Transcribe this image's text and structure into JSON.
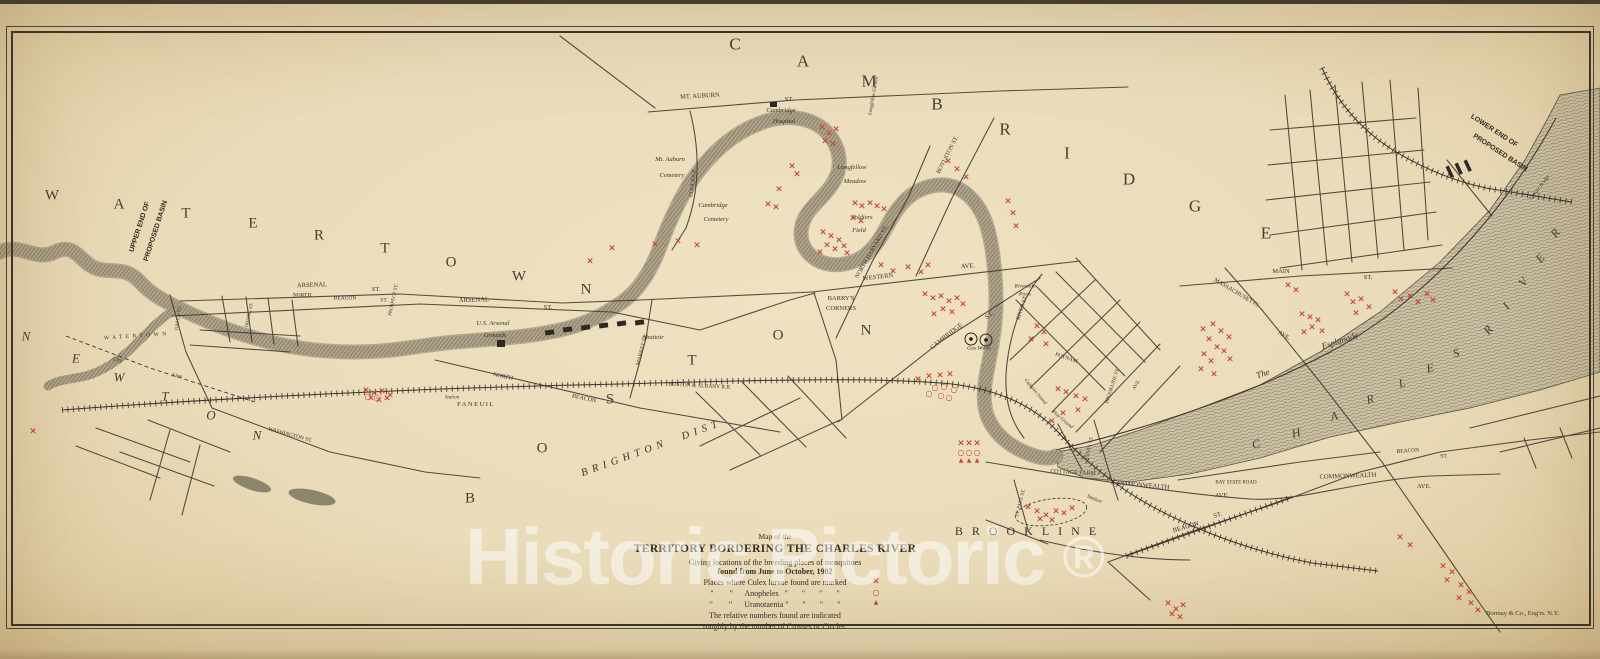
{
  "title_note": "Map of the Territory Bordering the Charles River, 1902",
  "colors": {
    "paper": "#eadcba",
    "ink": "#3a332a",
    "red_marker": "#c7453c",
    "water": "#b3a98f",
    "watermark": "#ffffff"
  },
  "watermark": {
    "text": "Historic Pictoric",
    "registered": "®"
  },
  "credit": "Bormay & Co., Eng'rs. N.Y.",
  "legend": {
    "l1": "Map of the",
    "l2": "TERRITORY BORDERING THE CHARLES RIVER",
    "l3": "Giving locations of the breeding places of mosquitoes",
    "l4": "found from June to October, 1902",
    "l5": "Places where Culex larvae found are marked",
    "l6": "\"        \"      Anopheles   \"       \"       \"       \"",
    "l7": "\"        \"      Uranotaenia \"       \"       \"       \"",
    "l8": "The relative numbers found are indicated",
    "l9": "roughly by the number of Crosses or Circles.",
    "markers": [
      "×",
      "○",
      "▲"
    ]
  },
  "districts": [
    {
      "name": "CAMBRIDGE",
      "s": 17,
      "letters": [
        [
          "C",
          735,
          44
        ],
        [
          "A",
          803,
          61
        ],
        [
          "M",
          869,
          81
        ],
        [
          "B",
          937,
          104
        ],
        [
          "R",
          1005,
          129
        ],
        [
          "I",
          1067,
          153
        ],
        [
          "D",
          1129,
          179
        ],
        [
          "G",
          1195,
          206
        ],
        [
          "E",
          1266,
          233
        ]
      ]
    },
    {
      "name": "WATERTOWN",
      "s": 15,
      "letters": [
        [
          "W",
          52,
          196
        ],
        [
          "A",
          119,
          205
        ],
        [
          "T",
          186,
          214
        ],
        [
          "E",
          253,
          224
        ],
        [
          "R",
          319,
          236
        ],
        [
          "T",
          385,
          249
        ],
        [
          "O",
          451,
          263
        ],
        [
          "W",
          519,
          277
        ],
        [
          "N",
          586,
          290
        ]
      ]
    },
    {
      "name": "BOSTON",
      "s": 15,
      "letters": [
        [
          "B",
          470,
          499
        ],
        [
          "O",
          542,
          449
        ],
        [
          "S",
          610,
          400
        ],
        [
          "T",
          692,
          361
        ],
        [
          "O",
          778,
          336
        ],
        [
          "N",
          866,
          331
        ]
      ]
    },
    {
      "name": "NEWTON",
      "s": 13,
      "i": 1,
      "letters": [
        [
          "N",
          26,
          336
        ],
        [
          "E",
          76,
          358
        ],
        [
          "W",
          119,
          377
        ],
        [
          "T",
          165,
          396
        ],
        [
          "O",
          211,
          415
        ],
        [
          "N",
          257,
          435
        ]
      ]
    },
    {
      "name": "CHARLES",
      "s": 12,
      "i": 1,
      "r": -15,
      "letters": [
        [
          "C",
          1256,
          444
        ],
        [
          "H",
          1296,
          433
        ],
        [
          "A",
          1334,
          416
        ],
        [
          "R",
          1370,
          399
        ],
        [
          "L",
          1402,
          383
        ],
        [
          "E",
          1430,
          368
        ],
        [
          "S",
          1456,
          353
        ]
      ]
    },
    {
      "name": "RIVER",
      "s": 12,
      "i": 1,
      "r": -50,
      "letters": [
        [
          "R",
          1488,
          330
        ],
        [
          "I",
          1506,
          306
        ],
        [
          "V",
          1523,
          282
        ],
        [
          "E",
          1540,
          258
        ],
        [
          "R",
          1555,
          233
        ]
      ]
    }
  ],
  "labels": [
    {
      "t": "MT. AUBURN",
      "x": 700,
      "y": 97,
      "r": -3
    },
    {
      "t": "ST.",
      "x": 789,
      "y": 100
    },
    {
      "t": "Cambridge",
      "x": 781,
      "y": 111,
      "c": "it"
    },
    {
      "t": "Hospital",
      "x": 784,
      "y": 122,
      "c": "it"
    },
    {
      "t": "Mt. Auburn",
      "x": 670,
      "y": 160,
      "c": "it"
    },
    {
      "t": "Cemetery",
      "x": 672,
      "y": 176,
      "c": "it"
    },
    {
      "t": "Cambridge",
      "x": 713,
      "y": 206,
      "c": "it"
    },
    {
      "t": "Cemetery",
      "x": 716,
      "y": 220,
      "c": "it"
    },
    {
      "t": "COOLIDGE",
      "x": 694,
      "y": 183,
      "r": -83,
      "s": 5.5
    },
    {
      "t": "Longfellow Garden",
      "x": 874,
      "y": 96,
      "r": -80,
      "s": 5,
      "c": "it"
    },
    {
      "t": "Longfellow",
      "x": 852,
      "y": 168,
      "c": "it"
    },
    {
      "t": "Meadow",
      "x": 855,
      "y": 182,
      "c": "it"
    },
    {
      "t": "BOYLSTON ST.",
      "x": 948,
      "y": 155,
      "r": -63,
      "s": 6
    },
    {
      "t": "Soldiers",
      "x": 862,
      "y": 218,
      "c": "it"
    },
    {
      "t": "Field",
      "x": 859,
      "y": 231,
      "c": "it"
    },
    {
      "t": "NORTH HARVARD ST.",
      "x": 872,
      "y": 252,
      "r": -60,
      "s": 6
    },
    {
      "t": "WESTERN",
      "x": 878,
      "y": 278,
      "r": -7
    },
    {
      "t": "AVE.",
      "x": 968,
      "y": 267,
      "r": -5
    },
    {
      "t": "BARRY'S",
      "x": 841,
      "y": 299
    },
    {
      "t": "CORNERS",
      "x": 841,
      "y": 309
    },
    {
      "t": "CAMBRIDGE",
      "x": 947,
      "y": 337,
      "r": -38
    },
    {
      "t": "ST.",
      "x": 990,
      "y": 316,
      "r": -38
    },
    {
      "t": "RIVER ST.",
      "x": 1023,
      "y": 308,
      "r": -72,
      "s": 5.5
    },
    {
      "t": "Riverside",
      "x": 1025,
      "y": 287,
      "c": "it",
      "s": 5.5
    },
    {
      "t": "Press",
      "x": 1025,
      "y": 295,
      "c": "it",
      "s": 5.5
    },
    {
      "t": "Gas Works",
      "x": 979,
      "y": 349,
      "c": "it",
      "s": 5.5
    },
    {
      "t": "PUTNAM",
      "x": 1066,
      "y": 359,
      "r": 18,
      "s": 5.5
    },
    {
      "t": "BROOKLINE ST.",
      "x": 1113,
      "y": 386,
      "r": -72,
      "s": 5
    },
    {
      "t": "AVE.",
      "x": 1137,
      "y": 385,
      "r": -60,
      "s": 5
    },
    {
      "t": "MASSACHUSETTS",
      "x": 1236,
      "y": 293,
      "r": 31,
      "s": 6
    },
    {
      "t": "AVE.",
      "x": 1284,
      "y": 336,
      "r": 31,
      "s": 6
    },
    {
      "t": "MAIN",
      "x": 1281,
      "y": 272
    },
    {
      "t": "ST.",
      "x": 1368,
      "y": 278
    },
    {
      "t": "The",
      "x": 1263,
      "y": 374,
      "r": -18,
      "c": "it",
      "s": 9
    },
    {
      "t": "Esplanade",
      "x": 1340,
      "y": 341,
      "r": -18,
      "c": "it",
      "s": 9
    },
    {
      "t": "Captains Island",
      "x": 1035,
      "y": 392,
      "r": 50,
      "s": 5,
      "c": "it"
    },
    {
      "t": "Play Ground",
      "x": 1062,
      "y": 420,
      "r": 40,
      "s": 5,
      "c": "it"
    },
    {
      "t": "COTTAGE FARM",
      "x": 1073,
      "y": 473,
      "r": 3,
      "s": 6
    },
    {
      "t": "COMMONWEALTH",
      "x": 1141,
      "y": 486,
      "r": 5
    },
    {
      "t": "AVE.",
      "x": 1222,
      "y": 496
    },
    {
      "t": "BAY STATE ROAD",
      "x": 1236,
      "y": 483,
      "s": 5
    },
    {
      "t": "COMMONWEALTH",
      "x": 1348,
      "y": 477,
      "r": -2
    },
    {
      "t": "AVE.",
      "x": 1424,
      "y": 487
    },
    {
      "t": "BEACON",
      "x": 1186,
      "y": 528,
      "r": -16
    },
    {
      "t": "ST.",
      "x": 1218,
      "y": 516,
      "r": -16
    },
    {
      "t": "BEACON",
      "x": 1408,
      "y": 452,
      "r": -4,
      "s": 5.5
    },
    {
      "t": "ST.",
      "x": 1444,
      "y": 457,
      "s": 5.5
    },
    {
      "t": "ST. PAUL ST.",
      "x": 1021,
      "y": 503,
      "r": -75,
      "s": 5
    },
    {
      "t": "ESSEX ST.",
      "x": 1090,
      "y": 448,
      "r": -78,
      "s": 5
    },
    {
      "t": "Station",
      "x": 1094,
      "y": 500,
      "r": 22,
      "c": "it",
      "s": 5.5
    },
    {
      "t": "ARSENAL",
      "x": 312,
      "y": 286,
      "r": -2
    },
    {
      "t": "ST.",
      "x": 376,
      "y": 290
    },
    {
      "t": "ARSENAL",
      "x": 474,
      "y": 301,
      "r": -2
    },
    {
      "t": "ST.",
      "x": 548,
      "y": 308
    },
    {
      "t": "U.S. Arsenal",
      "x": 493,
      "y": 324,
      "c": "it"
    },
    {
      "t": "Grounds",
      "x": 495,
      "y": 336,
      "c": "it"
    },
    {
      "t": "NORTH",
      "x": 302,
      "y": 296,
      "s": 5.5
    },
    {
      "t": "BEACON",
      "x": 345,
      "y": 299,
      "s": 5.5
    },
    {
      "t": "ST.",
      "x": 384,
      "y": 301,
      "s": 5.5
    },
    {
      "t": "PROSPECT ST.",
      "x": 394,
      "y": 300,
      "r": -78,
      "s": 5
    },
    {
      "t": "NORTH",
      "x": 503,
      "y": 377,
      "r": 12,
      "s": 6
    },
    {
      "t": "BEACON",
      "x": 584,
      "y": 399,
      "r": 12,
      "s": 6
    },
    {
      "t": "MARKET ST.",
      "x": 643,
      "y": 350,
      "r": -76,
      "s": 5.5
    },
    {
      "t": "BOSTON & ALBANY R.R.",
      "x": 700,
      "y": 387,
      "r": 3,
      "s": 5.5
    },
    {
      "t": "Station",
      "x": 452,
      "y": 398,
      "c": "it",
      "s": 5
    },
    {
      "t": "FANEUIL",
      "x": 476,
      "y": 405,
      "ls": 1.5
    },
    {
      "t": "WASHINGTON ST.",
      "x": 290,
      "y": 436,
      "r": 15,
      "s": 5.5
    },
    {
      "t": "IRVING ST.",
      "x": 250,
      "y": 315,
      "r": -78,
      "s": 5
    },
    {
      "t": "GALEN ST.",
      "x": 179,
      "y": 318,
      "r": -82,
      "s": 5
    },
    {
      "t": "City",
      "x": 117,
      "y": 361,
      "r": 12,
      "c": "it",
      "s": 5.5
    },
    {
      "t": "Line",
      "x": 177,
      "y": 377,
      "r": 12,
      "c": "it",
      "s": 5.5
    },
    {
      "t": "Abattoir",
      "x": 653,
      "y": 338,
      "c": "it"
    },
    {
      "t": "Craigie Bridge",
      "x": 1540,
      "y": 188,
      "r": -52,
      "s": 5,
      "c": "it"
    },
    {
      "t": "UPPER END OF",
      "x": 140,
      "y": 227,
      "r": -72,
      "s": 7,
      "c": "b"
    },
    {
      "t": "PROPOSED BASIN",
      "x": 156,
      "y": 231,
      "r": -72,
      "s": 7,
      "c": "b"
    },
    {
      "t": "LOWER END OF",
      "x": 1494,
      "y": 131,
      "r": 33,
      "s": 7,
      "c": "b"
    },
    {
      "t": "PROPOSED BASIN",
      "x": 1500,
      "y": 153,
      "r": 33,
      "s": 7,
      "c": "b"
    },
    {
      "t": "BRIGHTON  DIST",
      "x": 652,
      "y": 449,
      "r": -20,
      "s": 10.5,
      "ls": 5,
      "c": "it"
    },
    {
      "t": "BROOKLINE",
      "x": 1030,
      "y": 531,
      "s": 12,
      "ls": 9
    },
    {
      "t": "WATERTOWN",
      "x": 137,
      "y": 337,
      "r": -4,
      "s": 5.5,
      "ls": 3.5
    }
  ],
  "markers": {
    "cross": [
      [
        822,
        128
      ],
      [
        829,
        134
      ],
      [
        836,
        130
      ],
      [
        825,
        142
      ],
      [
        833,
        145
      ],
      [
        948,
        162
      ],
      [
        957,
        170
      ],
      [
        966,
        178
      ],
      [
        1008,
        202
      ],
      [
        1013,
        214
      ],
      [
        1016,
        227
      ],
      [
        792,
        167
      ],
      [
        797,
        175
      ],
      [
        779,
        190
      ],
      [
        768,
        205
      ],
      [
        776,
        208
      ],
      [
        590,
        262
      ],
      [
        612,
        249
      ],
      [
        655,
        245
      ],
      [
        678,
        242
      ],
      [
        697,
        246
      ],
      [
        855,
        204
      ],
      [
        862,
        207
      ],
      [
        870,
        204
      ],
      [
        877,
        207
      ],
      [
        884,
        210
      ],
      [
        853,
        219
      ],
      [
        861,
        222
      ],
      [
        823,
        233
      ],
      [
        831,
        237
      ],
      [
        839,
        241
      ],
      [
        827,
        246
      ],
      [
        835,
        250
      ],
      [
        844,
        247
      ],
      [
        820,
        253
      ],
      [
        847,
        254
      ],
      [
        881,
        266
      ],
      [
        893,
        272
      ],
      [
        908,
        268
      ],
      [
        921,
        273
      ],
      [
        928,
        266
      ],
      [
        925,
        295
      ],
      [
        933,
        299
      ],
      [
        941,
        297
      ],
      [
        949,
        302
      ],
      [
        957,
        299
      ],
      [
        963,
        305
      ],
      [
        943,
        310
      ],
      [
        952,
        313
      ],
      [
        934,
        315
      ],
      [
        1058,
        390
      ],
      [
        1066,
        393
      ],
      [
        1076,
        397
      ],
      [
        1085,
        400
      ],
      [
        1078,
        411
      ],
      [
        1063,
        414
      ],
      [
        1052,
        422
      ],
      [
        918,
        380
      ],
      [
        929,
        377
      ],
      [
        940,
        376
      ],
      [
        950,
        375
      ],
      [
        1037,
        327
      ],
      [
        1044,
        333
      ],
      [
        1031,
        340
      ],
      [
        1046,
        345
      ],
      [
        961,
        444
      ],
      [
        969,
        444
      ],
      [
        977,
        444
      ],
      [
        366,
        391
      ],
      [
        374,
        394
      ],
      [
        382,
        392
      ],
      [
        390,
        396
      ],
      [
        371,
        399
      ],
      [
        379,
        401
      ],
      [
        387,
        399
      ],
      [
        33,
        432
      ],
      [
        1203,
        330
      ],
      [
        1213,
        325
      ],
      [
        1221,
        332
      ],
      [
        1209,
        340
      ],
      [
        1229,
        338
      ],
      [
        1217,
        348
      ],
      [
        1204,
        355
      ],
      [
        1224,
        352
      ],
      [
        1211,
        362
      ],
      [
        1230,
        360
      ],
      [
        1201,
        370
      ],
      [
        1214,
        375
      ],
      [
        1302,
        315
      ],
      [
        1310,
        318
      ],
      [
        1318,
        321
      ],
      [
        1312,
        328
      ],
      [
        1322,
        332
      ],
      [
        1304,
        333
      ],
      [
        1347,
        295
      ],
      [
        1353,
        303
      ],
      [
        1361,
        300
      ],
      [
        1369,
        308
      ],
      [
        1356,
        314
      ],
      [
        1395,
        293
      ],
      [
        1401,
        300
      ],
      [
        1410,
        297
      ],
      [
        1418,
        303
      ],
      [
        1427,
        295
      ],
      [
        1433,
        301
      ],
      [
        1288,
        286
      ],
      [
        1296,
        291
      ],
      [
        1028,
        508
      ],
      [
        1037,
        512
      ],
      [
        1046,
        516
      ],
      [
        1056,
        512
      ],
      [
        1064,
        514
      ],
      [
        1072,
        509
      ],
      [
        1040,
        520
      ],
      [
        1052,
        521
      ],
      [
        1400,
        538
      ],
      [
        1410,
        546
      ],
      [
        1443,
        567
      ],
      [
        1452,
        573
      ],
      [
        1447,
        581
      ],
      [
        1461,
        586
      ],
      [
        1469,
        593
      ],
      [
        1459,
        599
      ],
      [
        1471,
        604
      ],
      [
        1478,
        611
      ],
      [
        1168,
        604
      ],
      [
        1176,
        610
      ],
      [
        1183,
        606
      ],
      [
        1172,
        615
      ],
      [
        1180,
        618
      ]
    ],
    "circle": [
      [
        935,
        388
      ],
      [
        944,
        387
      ],
      [
        954,
        390
      ],
      [
        941,
        396
      ],
      [
        949,
        398
      ],
      [
        929,
        394
      ],
      [
        961,
        453
      ],
      [
        969,
        453
      ],
      [
        977,
        453
      ],
      [
        368,
        397
      ],
      [
        377,
        398
      ]
    ],
    "triangle": [
      [
        961,
        461
      ],
      [
        969,
        461
      ],
      [
        977,
        461
      ]
    ]
  }
}
